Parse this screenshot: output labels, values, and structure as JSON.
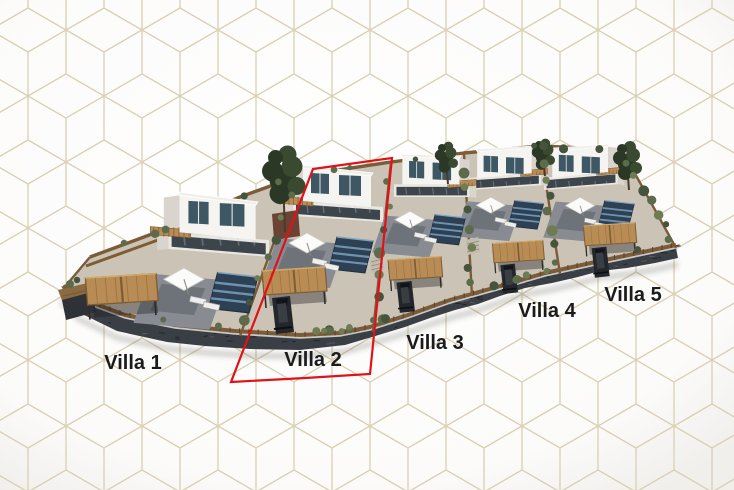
{
  "site": {
    "description_labels": [
      "Villa 1",
      "Villa 2",
      "Villa 3",
      "Villa 4",
      "Villa 5"
    ],
    "highlighted_villa": "Villa 2"
  },
  "villas": [
    {
      "label": "Villa 1",
      "highlighted": false
    },
    {
      "label": "Villa 2",
      "highlighted": true
    },
    {
      "label": "Villa 3",
      "highlighted": false
    },
    {
      "label": "Villa 4",
      "highlighted": false
    },
    {
      "label": "Villa 5",
      "highlighted": false
    }
  ],
  "colors": {
    "background": "#ffffff",
    "background_edge": "#f3f1ee",
    "pattern_line": "#d9cfb2",
    "highlight_red": "#e11217",
    "label_text": "#1b1b1b",
    "wood": "#b98c55",
    "wood_light": "#d2a96b",
    "wood_dark": "#7e5c34",
    "fence": "#7c5b38",
    "stone_wall": "#3a3e45",
    "stone_dark": "#22262c",
    "stone_light": "#565b63",
    "gravel": "#cbc4b6",
    "terrace": "#888c92",
    "terrace_dark": "#6e7279",
    "pool": "#2d4054",
    "pool_lane": "#6f93ae",
    "pool_edge": "#7fa3c0",
    "building_front": "#f6f4f0",
    "building_side": "#d9d5ce",
    "building_base": "#e9e7e1",
    "parapet": "#f0eee9",
    "window": "#3e5764",
    "glass_dark": "#3c444c",
    "bush": "#5c6b49",
    "bush_light": "#6d7c52",
    "bush_dark": "#46543d",
    "tree": "#2c3826",
    "tree_light": "#3a4a30",
    "planter": "#6b4334",
    "car": "#23262b",
    "car_roof": "#393e45",
    "umbrella": "#fbfbfa"
  }
}
